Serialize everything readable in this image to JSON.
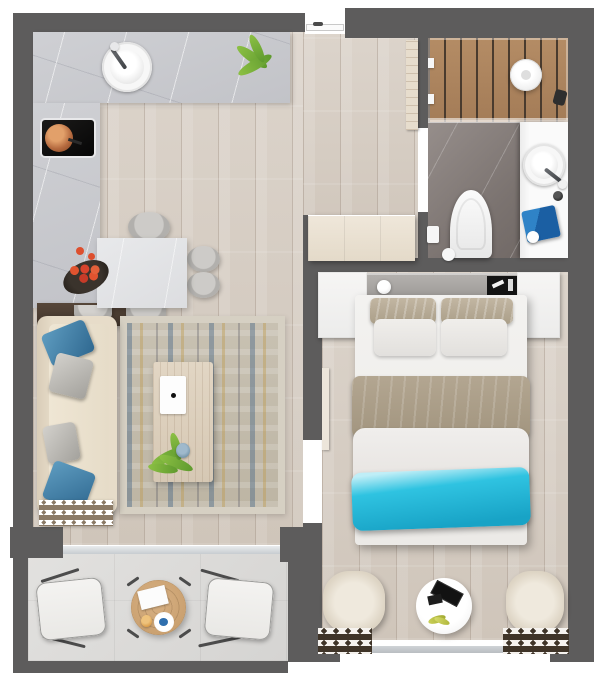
{
  "floorplan": {
    "view": "top-down 3d apartment render",
    "rooms": [
      {
        "id": "kitchen-living-room",
        "floor": "light-oak-planks",
        "furniture": [
          "l-shaped-marble-counter",
          "round-vessel-sink",
          "kitchen-faucet",
          "black-cooktop",
          "copper-pan",
          "herb-plant",
          "marble-dining-table",
          "fruit-bowl",
          "dining-chairs-x4",
          "dark-sideboard",
          "cream-sofa",
          "blue-pillows-x2",
          "gray-pillows-x2",
          "white-knit-throw",
          "abstract-blue-gold-rug",
          "wood-coffee-table",
          "white-tray",
          "green-plant",
          "blue-cup"
        ]
      },
      {
        "id": "hallway",
        "floor": "light-oak-planks",
        "furniture": [
          "entry-door",
          "wood-dresser",
          "bathroom-door"
        ]
      },
      {
        "id": "bathroom",
        "floor": "gray-marble",
        "furniture": [
          "teak-shower-deck",
          "rain-shower-head",
          "shower-mixer",
          "glass-partition",
          "white-vanity",
          "round-vessel-sink",
          "vanity-faucet",
          "blue-towel",
          "soap-dish",
          "wall-hung-toilet",
          "toilet-paper-holder",
          "waste-bin"
        ]
      },
      {
        "id": "bedroom",
        "floor": "light-oak-planks",
        "furniture": [
          "double-bed",
          "taupe-pillows-x2",
          "white-pillows-x2",
          "taupe-throw-blanket",
          "white-duvet",
          "teal-blanket",
          "headboard-shelf",
          "ball-lamp",
          "black-media-nook",
          "wardrobe-left",
          "wardrobe-right",
          "bedroom-door",
          "cream-armchairs-x2",
          "round-side-table",
          "black-magazine",
          "potted-plant",
          "sherpa-rugs-x2",
          "bottom-window"
        ]
      },
      {
        "id": "balcony",
        "floor": "concrete-tiles",
        "furniture": [
          "lounge-chairs-x2",
          "round-oak-table",
          "paper-sheet",
          "amber-drink",
          "plate-with-food"
        ]
      }
    ],
    "palette": {
      "wall": "#5d5c5c",
      "outside": "#ffffff",
      "wood-a": "#dcd4cb",
      "wood-b": "#cfc5ba",
      "concrete-a": "#e2e1df",
      "concrete-b": "#d5d4d2",
      "bath-a": "#968e8b",
      "bath-b": "#6b6360",
      "deck-wood": "#b48c65",
      "deck-slat": "#4a3b2e",
      "counter-a": "#cfd0d4",
      "counter-b": "#c2c3c8",
      "table-marble": "#e8e9eb",
      "sofa": "#e7dcc9",
      "sofa-seat": "#efe6d4",
      "pillow-blue-a": "#5e9cc0",
      "pillow-blue-b": "#2f6890",
      "pillow-gray": "#a3a19c",
      "rug-base": "#c8c1b2",
      "coffee-table": "#e2d6c4",
      "bench": "#43372e",
      "chair": "#b2b0ad",
      "fruit": "#dd4f2e",
      "copper": "#b56a3f",
      "plant-a": "#8cc044",
      "plant-b": "#5f9a2e",
      "wardrobe": "#ececeb",
      "headboard": "#9d9a97",
      "tv": "#141414",
      "sheet": "#eceae7",
      "pillow-taupe": "#ab9f89",
      "pillow-white": "#e2e0dd",
      "blanket-taupe": "#a2957f",
      "duvet": "#e6e3e0",
      "teal": "#2fc3e1",
      "armchair": "#cfc6b5",
      "towel-a": "#2f83c7",
      "towel-b": "#1b5fa3",
      "dresser": "#e4dac9",
      "oak": "#c49a68"
    }
  }
}
